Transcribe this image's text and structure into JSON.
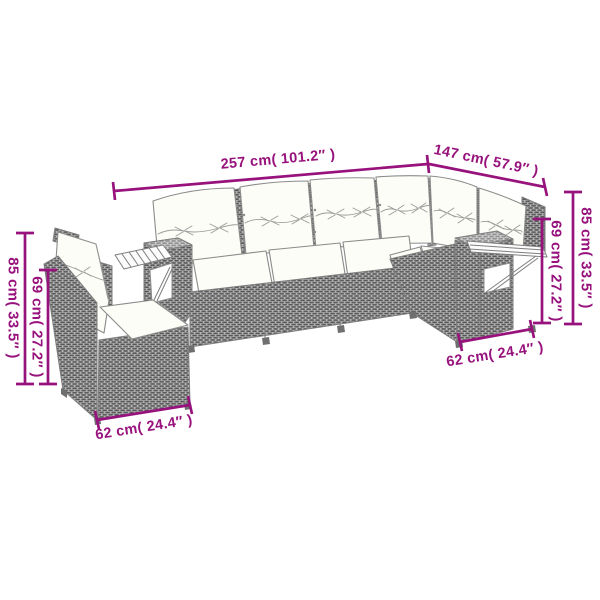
{
  "palette": {
    "background": "#ffffff",
    "dimension_color": "#97127c",
    "outline_color": "#7e7e7e",
    "wicker_base": "#b4b4b4",
    "wicker_dash": "#565656",
    "wicker_top_base": "#cfcfcf",
    "wicker_top_dash": "#8f8f8f",
    "cushion_fill": "#fdfdf7"
  },
  "dimensions": {
    "total_width": {
      "label": "257 cm( 101.2″ )",
      "cm": 257,
      "inches": 101.2
    },
    "chaise_width": {
      "label": "147 cm( 57.9″ )",
      "cm": 147,
      "inches": 57.9
    },
    "back_height_right": {
      "label": "85 cm( 33.5″ )",
      "cm": 85,
      "inches": 33.5
    },
    "arm_height_right": {
      "label": "69 cm( 27.2″ )",
      "cm": 69,
      "inches": 27.2
    },
    "back_height_left": {
      "label": "85 cm( 33.5″ )",
      "cm": 85,
      "inches": 33.5
    },
    "arm_height_left": {
      "label": "69 cm( 27.2″ )",
      "cm": 69,
      "inches": 27.2
    },
    "seat_depth_left": {
      "label": "62 cm( 24.4″ )",
      "cm": 62,
      "inches": 24.4
    },
    "seat_depth_right": {
      "label": "62 cm( 24.4″ )",
      "cm": 62,
      "inches": 24.4
    }
  }
}
